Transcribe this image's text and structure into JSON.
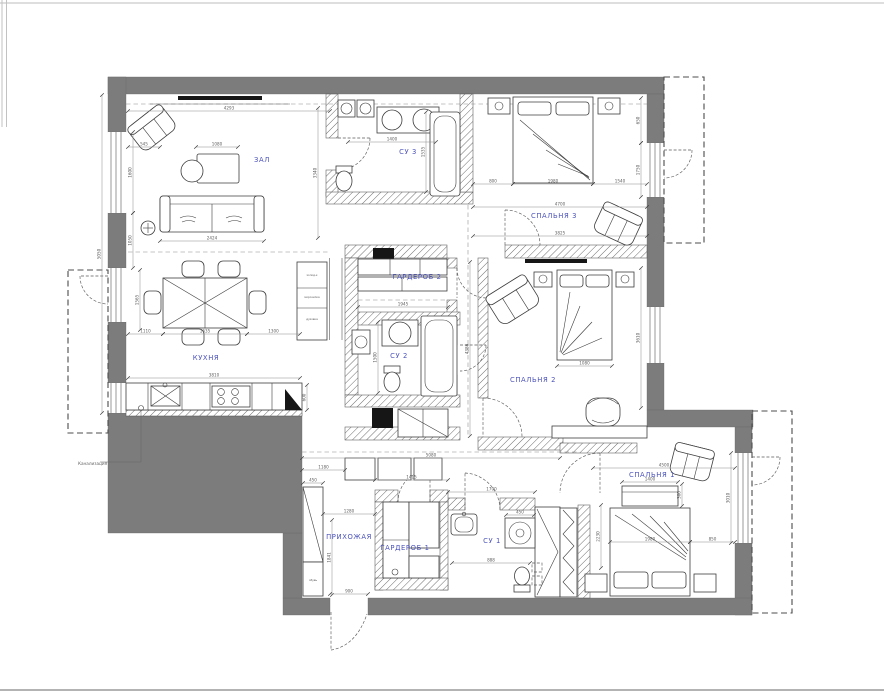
{
  "plan": {
    "wall_color": "#7c7c7c",
    "label_color": "#4b52bb",
    "dim_color": "#5e5e5e",
    "rooms": [
      {
        "id": "zal",
        "label": "ЗАЛ",
        "x": 262,
        "y": 162
      },
      {
        "id": "su3",
        "label": "СУ 3",
        "x": 408,
        "y": 154
      },
      {
        "id": "spalnya3",
        "label": "СПАЛЬНЯ 3",
        "x": 554,
        "y": 218
      },
      {
        "id": "kuhnya",
        "label": "КУХНЯ",
        "x": 206,
        "y": 360
      },
      {
        "id": "garderob2",
        "label": "ГАРДЕРОБ 2",
        "x": 417,
        "y": 279
      },
      {
        "id": "su2",
        "label": "СУ 2",
        "x": 399,
        "y": 358
      },
      {
        "id": "spalnya2",
        "label": "СПАЛЬНЯ 2",
        "x": 533,
        "y": 382
      },
      {
        "id": "prihozhaya",
        "label": "ПРИХОЖАЯ",
        "x": 349,
        "y": 539
      },
      {
        "id": "garderob1",
        "label": "ГАРДЕРОБ 1",
        "x": 405,
        "y": 550
      },
      {
        "id": "su1",
        "label": "СУ 1",
        "x": 492,
        "y": 543
      },
      {
        "id": "spalnya1",
        "label": "СПАЛЬНЯ 1",
        "x": 652,
        "y": 477
      }
    ],
    "sewer_label": "Канализация",
    "shoe_label": "обувь",
    "cabinet_labels": [
      "холод-к",
      "морозилка",
      "духовка"
    ],
    "dims": [
      [
        "4293",
        128,
        111,
        330,
        111
      ],
      [
        "545",
        128,
        147,
        160,
        147
      ],
      [
        "1080",
        196,
        147,
        238,
        147
      ],
      [
        "2424",
        160,
        241,
        264,
        241
      ],
      [
        "3340",
        318,
        108,
        318,
        238
      ],
      [
        "1400",
        348,
        142,
        436,
        142
      ],
      [
        "1535",
        426,
        112,
        426,
        192
      ],
      [
        "800",
        473,
        184,
        513,
        184
      ],
      [
        "1980",
        513,
        184,
        593,
        184
      ],
      [
        "1540",
        593,
        184,
        647,
        184
      ],
      [
        "4700",
        473,
        207,
        647,
        207
      ],
      [
        "3825",
        473,
        236,
        647,
        236
      ],
      [
        "650",
        641,
        98,
        641,
        143
      ],
      [
        "1750",
        641,
        143,
        641,
        197
      ],
      [
        "1110",
        128,
        334,
        163,
        334
      ],
      [
        "1635",
        163,
        334,
        247,
        334
      ],
      [
        "1300",
        247,
        334,
        300,
        334
      ],
      [
        "3810",
        128,
        378,
        300,
        378
      ],
      [
        "1565",
        140,
        270,
        140,
        330
      ],
      [
        "600",
        307,
        385,
        307,
        410
      ],
      [
        "1945",
        358,
        307,
        448,
        307
      ],
      [
        "1500",
        378,
        322,
        378,
        393
      ],
      [
        "3610",
        641,
        268,
        641,
        408
      ],
      [
        "1080",
        557,
        366,
        612,
        366
      ],
      [
        "4386",
        470,
        262,
        470,
        436
      ],
      [
        "1400",
        622,
        482,
        678,
        482
      ],
      [
        "300",
        682,
        484,
        682,
        506
      ],
      [
        "1980",
        610,
        542,
        690,
        542
      ],
      [
        "850",
        690,
        542,
        735,
        542
      ],
      [
        "4500",
        593,
        468,
        735,
        468
      ],
      [
        "2230",
        601,
        505,
        601,
        568
      ],
      [
        "450",
        303,
        483,
        323,
        483
      ],
      [
        "1280",
        323,
        514,
        375,
        514
      ],
      [
        "1841",
        332,
        520,
        332,
        595
      ],
      [
        "900",
        330,
        594,
        368,
        594
      ],
      [
        "5080",
        302,
        458,
        560,
        458
      ],
      [
        "1415",
        375,
        480,
        448,
        480
      ],
      [
        "1700",
        448,
        492,
        535,
        492
      ],
      [
        "888",
        452,
        563,
        530,
        563
      ],
      [
        "450",
        506,
        515,
        534,
        515
      ],
      [
        "1600",
        133,
        132,
        133,
        213
      ],
      [
        "1050",
        133,
        213,
        133,
        268
      ],
      [
        "5050",
        102,
        95,
        102,
        413
      ],
      [
        "3010",
        731,
        453,
        731,
        543
      ],
      [
        "1180",
        302,
        470,
        345,
        470
      ]
    ]
  }
}
